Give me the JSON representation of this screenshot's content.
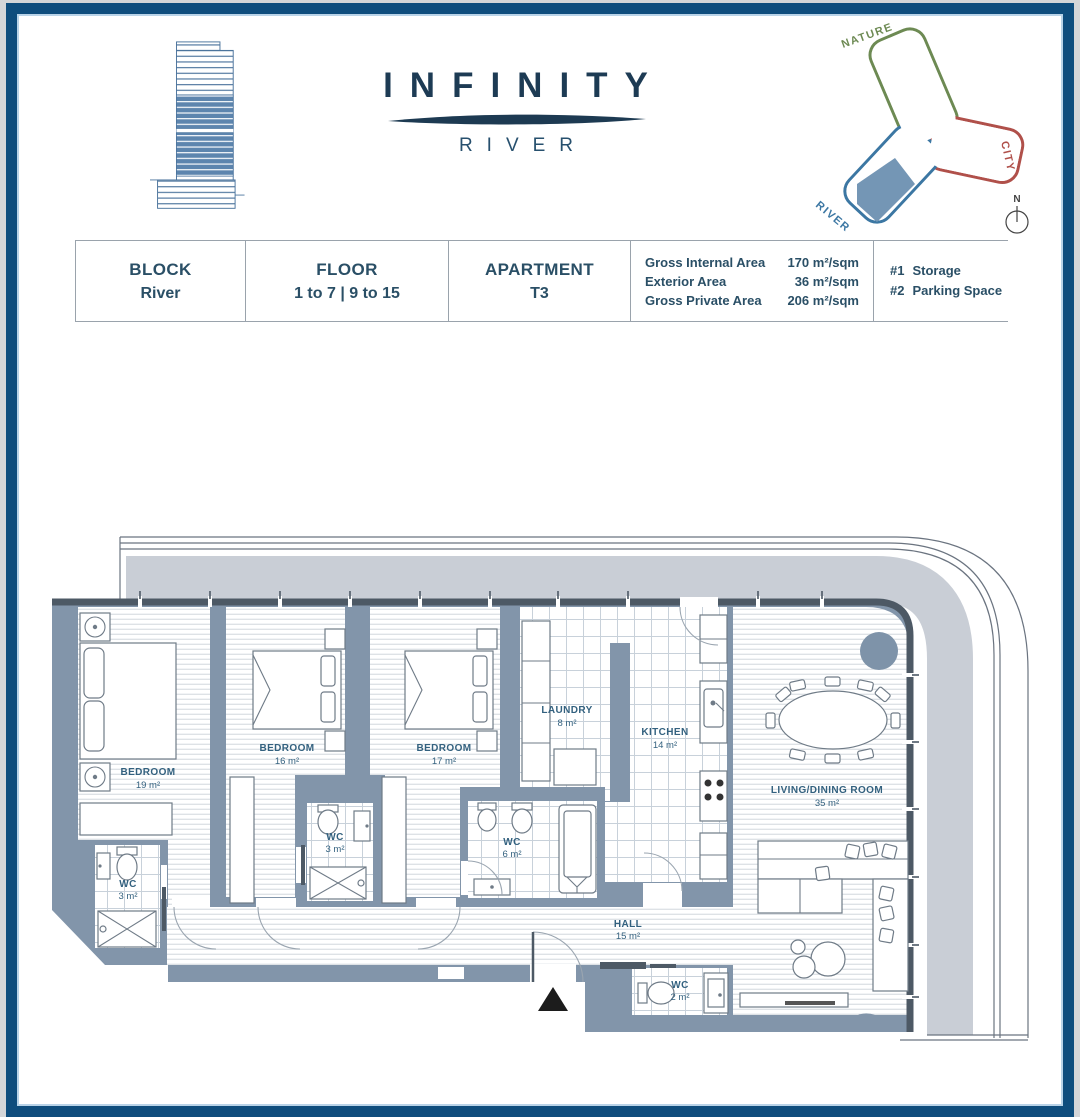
{
  "logo": {
    "title": "INFINITY",
    "subtitle": "RIVER"
  },
  "site_diagram": {
    "nature": "NATURE",
    "city": "CITY",
    "river": "RIVER",
    "compass": "N"
  },
  "info_table": {
    "columns": [
      {
        "label": "BLOCK",
        "value": "River"
      },
      {
        "label": "FLOOR",
        "value": "1 to 7 | 9 to 15"
      },
      {
        "label": "APARTMENT",
        "value": "T3"
      }
    ],
    "areas": [
      {
        "label": "Gross Internal Area",
        "value": "170 m²/sqm"
      },
      {
        "label": "Exterior Area",
        "value": "36 m²/sqm"
      },
      {
        "label": "Gross Private Area",
        "value": "206 m²/sqm"
      }
    ],
    "extras": [
      {
        "num": "#1",
        "label": "Storage"
      },
      {
        "num": "#2",
        "label": "Parking Space"
      }
    ]
  },
  "floorplan": {
    "rooms": [
      {
        "name": "BEDROOM",
        "area": "19 m²"
      },
      {
        "name": "BEDROOM",
        "area": "16 m²"
      },
      {
        "name": "BEDROOM",
        "area": "17 m²"
      },
      {
        "name": "LAUNDRY",
        "area": "8 m²"
      },
      {
        "name": "KITCHEN",
        "area": "14 m²"
      },
      {
        "name": "LIVING/DINING ROOM",
        "area": "35 m²"
      },
      {
        "name": "WC",
        "area": "3 m²"
      },
      {
        "name": "WC",
        "area": "3 m²"
      },
      {
        "name": "WC",
        "area": "6 m²"
      },
      {
        "name": "HALL",
        "area": "15 m²"
      },
      {
        "name": "WC",
        "area": "2 m²"
      }
    ]
  },
  "colors": {
    "frame_navy": "#0f4d7d",
    "wall_blue_gray": "#8295aa",
    "terrace_gray": "#c9ced6",
    "window_wall": "#4d5965",
    "label_blue": "#33617f",
    "nature_green": "#6d8a53",
    "city_red": "#b0504a",
    "river_blue": "#3c77a3",
    "unit_fill_blue": "#7496b5"
  }
}
